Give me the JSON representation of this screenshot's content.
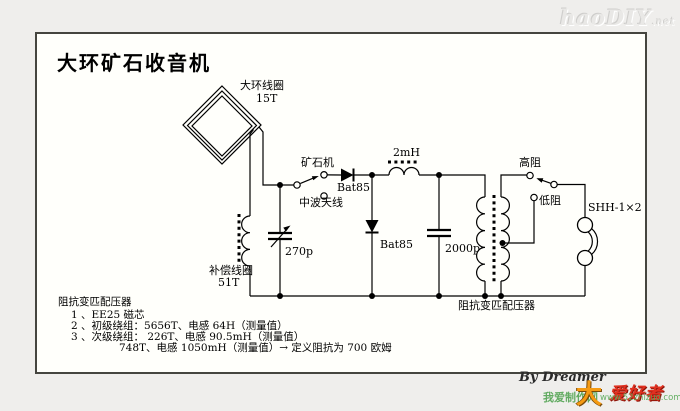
{
  "site_logo": {
    "text": "haoDIY",
    "suffix": ".net"
  },
  "diagram": {
    "title": "大环矿石收音机",
    "labels": {
      "loop_coil": "大环线圈",
      "loop_turns": "15T",
      "crystal_set": "矿石机",
      "mw_antenna": "中波天线",
      "diode1": "Bat85",
      "diode2": "Bat85",
      "inductor": "2mH",
      "var_cap": "270p",
      "cap": "2000p",
      "comp_coil": "补偿线圈",
      "comp_turns": "51T",
      "high_z": "高阻",
      "low_z": "低阻",
      "earphone": "SHH-1×2",
      "transformer": "阻抗变匹配压器"
    },
    "notes": {
      "header": "阻抗变匹配压器",
      "items": [
        "1 、EE25 磁芯",
        "2 、初级绕组：5656T、电感 64H（测量值）",
        "3 、次级绕组：  226T、电感 90.5mH（测量值）",
        "748T、电感 1050mH（测量值）→ 定义阻抗为 700 欧姆"
      ]
    },
    "credit": "By Dreamer"
  },
  "watermark": {
    "prefix": "我爱制作网",
    "logo_char": "大",
    "logo_text": "爱好者",
    "url": "www.52zhizuo.com"
  }
}
